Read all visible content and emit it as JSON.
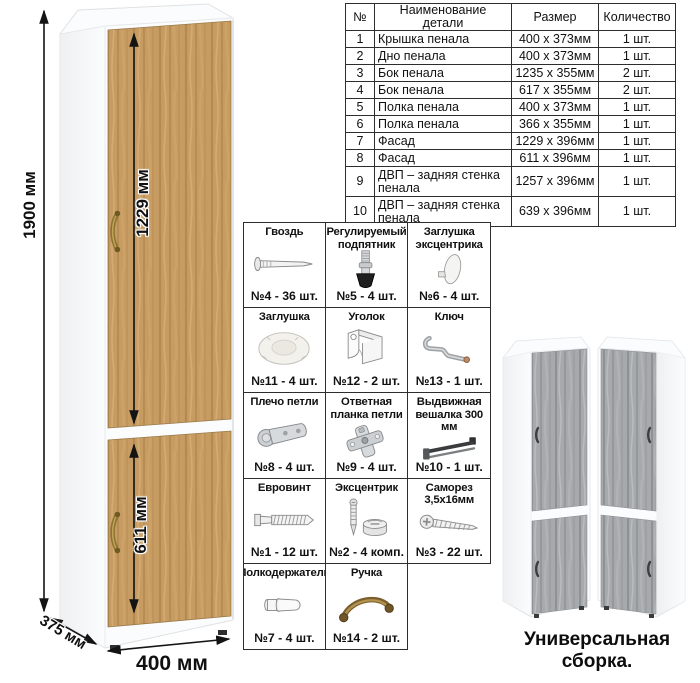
{
  "dimensions": {
    "height_label": "1900 мм",
    "upper_door_label": "1229 мм",
    "lower_door_label": "611 мм",
    "depth_label": "375 мм",
    "width_label": "400 мм"
  },
  "parts_table": {
    "headers": [
      "№",
      "Наименование детали",
      "Размер",
      "Количество"
    ],
    "rows": [
      [
        "1",
        "Крышка пенала",
        "400 х 373мм",
        "1 шт."
      ],
      [
        "2",
        "Дно пенала",
        "400 х 373мм",
        "1 шт."
      ],
      [
        "3",
        "Бок пенала",
        "1235 х 355мм",
        "2 шт."
      ],
      [
        "4",
        "Бок пенала",
        "617 х 355мм",
        "2 шт."
      ],
      [
        "5",
        "Полка пенала",
        "400 х 373мм",
        "1 шт."
      ],
      [
        "6",
        "Полка пенала",
        "366 х 355мм",
        "1 шт."
      ],
      [
        "7",
        "Фасад",
        "1229 х 396мм",
        "1 шт."
      ],
      [
        "8",
        "Фасад",
        "611 х 396мм",
        "1 шт."
      ],
      [
        "9",
        "ДВП – задняя стенка пенала",
        "1257 х 396мм",
        "1 шт."
      ],
      [
        "10",
        "ДВП – задняя стенка пенала",
        "639 х 396мм",
        "1 шт."
      ]
    ]
  },
  "hardware": {
    "items": [
      {
        "title": "Гвоздь",
        "count": "№4 - 36 шт.",
        "icon": "nail-icon"
      },
      {
        "title": "Регулируемый подпятник",
        "count": "№5 - 4 шт.",
        "icon": "adjustable-foot-icon"
      },
      {
        "title": "Заглушка эксцентрика",
        "count": "№6 - 4 шт.",
        "icon": "cam-cap-icon"
      },
      {
        "title": "Заглушка",
        "count": "№11 - 4 шт.",
        "icon": "cap-icon"
      },
      {
        "title": "Уголок",
        "count": "№12 - 2 шт.",
        "icon": "corner-bracket-icon"
      },
      {
        "title": "Ключ",
        "count": "№13 - 1 шт.",
        "icon": "hex-key-icon"
      },
      {
        "title": "Плечо петли",
        "count": "№8 - 4 шт.",
        "icon": "hinge-arm-icon"
      },
      {
        "title": "Ответная планка петли",
        "count": "№9 - 4 шт.",
        "icon": "hinge-plate-icon"
      },
      {
        "title": "Выдвижная вешалка 300 мм",
        "count": "№10 - 1 шт.",
        "icon": "pullout-hanger-icon"
      },
      {
        "title": "Евровинт",
        "count": "№1 - 12 шт.",
        "icon": "euro-screw-icon"
      },
      {
        "title": "Эксцентрик",
        "count": "№2 - 4 комп.",
        "icon": "cam-lock-icon"
      },
      {
        "title": "Саморез 3,5х16мм",
        "count": "№3 - 22 шт.",
        "icon": "self-tapping-screw-icon"
      },
      {
        "title": "Полкодержатель",
        "count": "№7 - 4 шт.",
        "icon": "shelf-pin-icon"
      },
      {
        "title": "Ручка",
        "count": "№14 - 2 шт.",
        "icon": "handle-icon"
      }
    ]
  },
  "footer": {
    "caption": "Универсальная сборка."
  },
  "colors": {
    "wood": "#c79c62",
    "wood_dark": "#aa7d45",
    "gray_wood": "#a7aaac",
    "handle_brass": "#8a7434",
    "carcass_white": "#fbfcfd",
    "border_dark": "#2d2d2d"
  }
}
